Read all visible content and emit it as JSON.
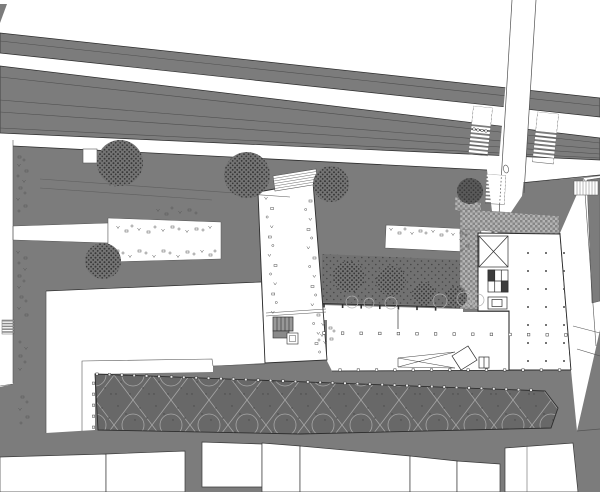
{
  "meta": {
    "type": "architectural-site-plan",
    "canvas_width": 600,
    "canvas_height": 492,
    "visible_text": "none (drawing contains only illegible micro-annotations rendered as symbol marks)"
  },
  "palette": {
    "bg": "#ffffff",
    "road": "#7c7c7c",
    "road_line": "#4f4f4f",
    "edge": "#2e2e2e",
    "white": "#ffffff",
    "garden": "#717171",
    "garden_dot": "#454545",
    "tree": "#747474",
    "tree_dot": "#383838",
    "tree_dark": "#595959",
    "canopy": "#686868",
    "canopy_line": "#a6a6a6",
    "canopy_dot": "#484848",
    "paving": "#b4b4b4",
    "paving_dot": "#868686",
    "mark": "#565656",
    "thin": "#555555",
    "tick": "#e9e9e9",
    "core_dark": "#3c3c3c",
    "kiosk": "#989898"
  },
  "features": {
    "railway_corridor": "two diagonal grey bands with lane lines, upper left to right",
    "north_south_street": "white street entering from top right with two zebra crossings",
    "plaza": "large grey public plaza with scattered furniture marks",
    "white_terraces": [
      "west plaza terrace with furniture marks",
      "central terrace near garden"
    ],
    "linear_building": "narrow white slab building crossing plaza north-south",
    "garden_courtyard": "dark planted court with stippled trees and shrub circles",
    "main_building": "column-grid floor plan with stair X, elevator bank and ramp",
    "paved_forecourt": "checker-textured paving wrapping building corner",
    "canopy_roof": "dark space-frame canopy band with diamond and circle pattern",
    "south_street": "curving grey street with white building parcels below",
    "sidewalk": "west sidewalk strip with micro-annotation symbols"
  },
  "counts": {
    "trees_stippled": 9,
    "shrub_circles": 6,
    "zebra_crossings": 4,
    "building_parcels_south": 8,
    "canopy_column_ticks_top": 36,
    "crossing_bollards": 4
  }
}
